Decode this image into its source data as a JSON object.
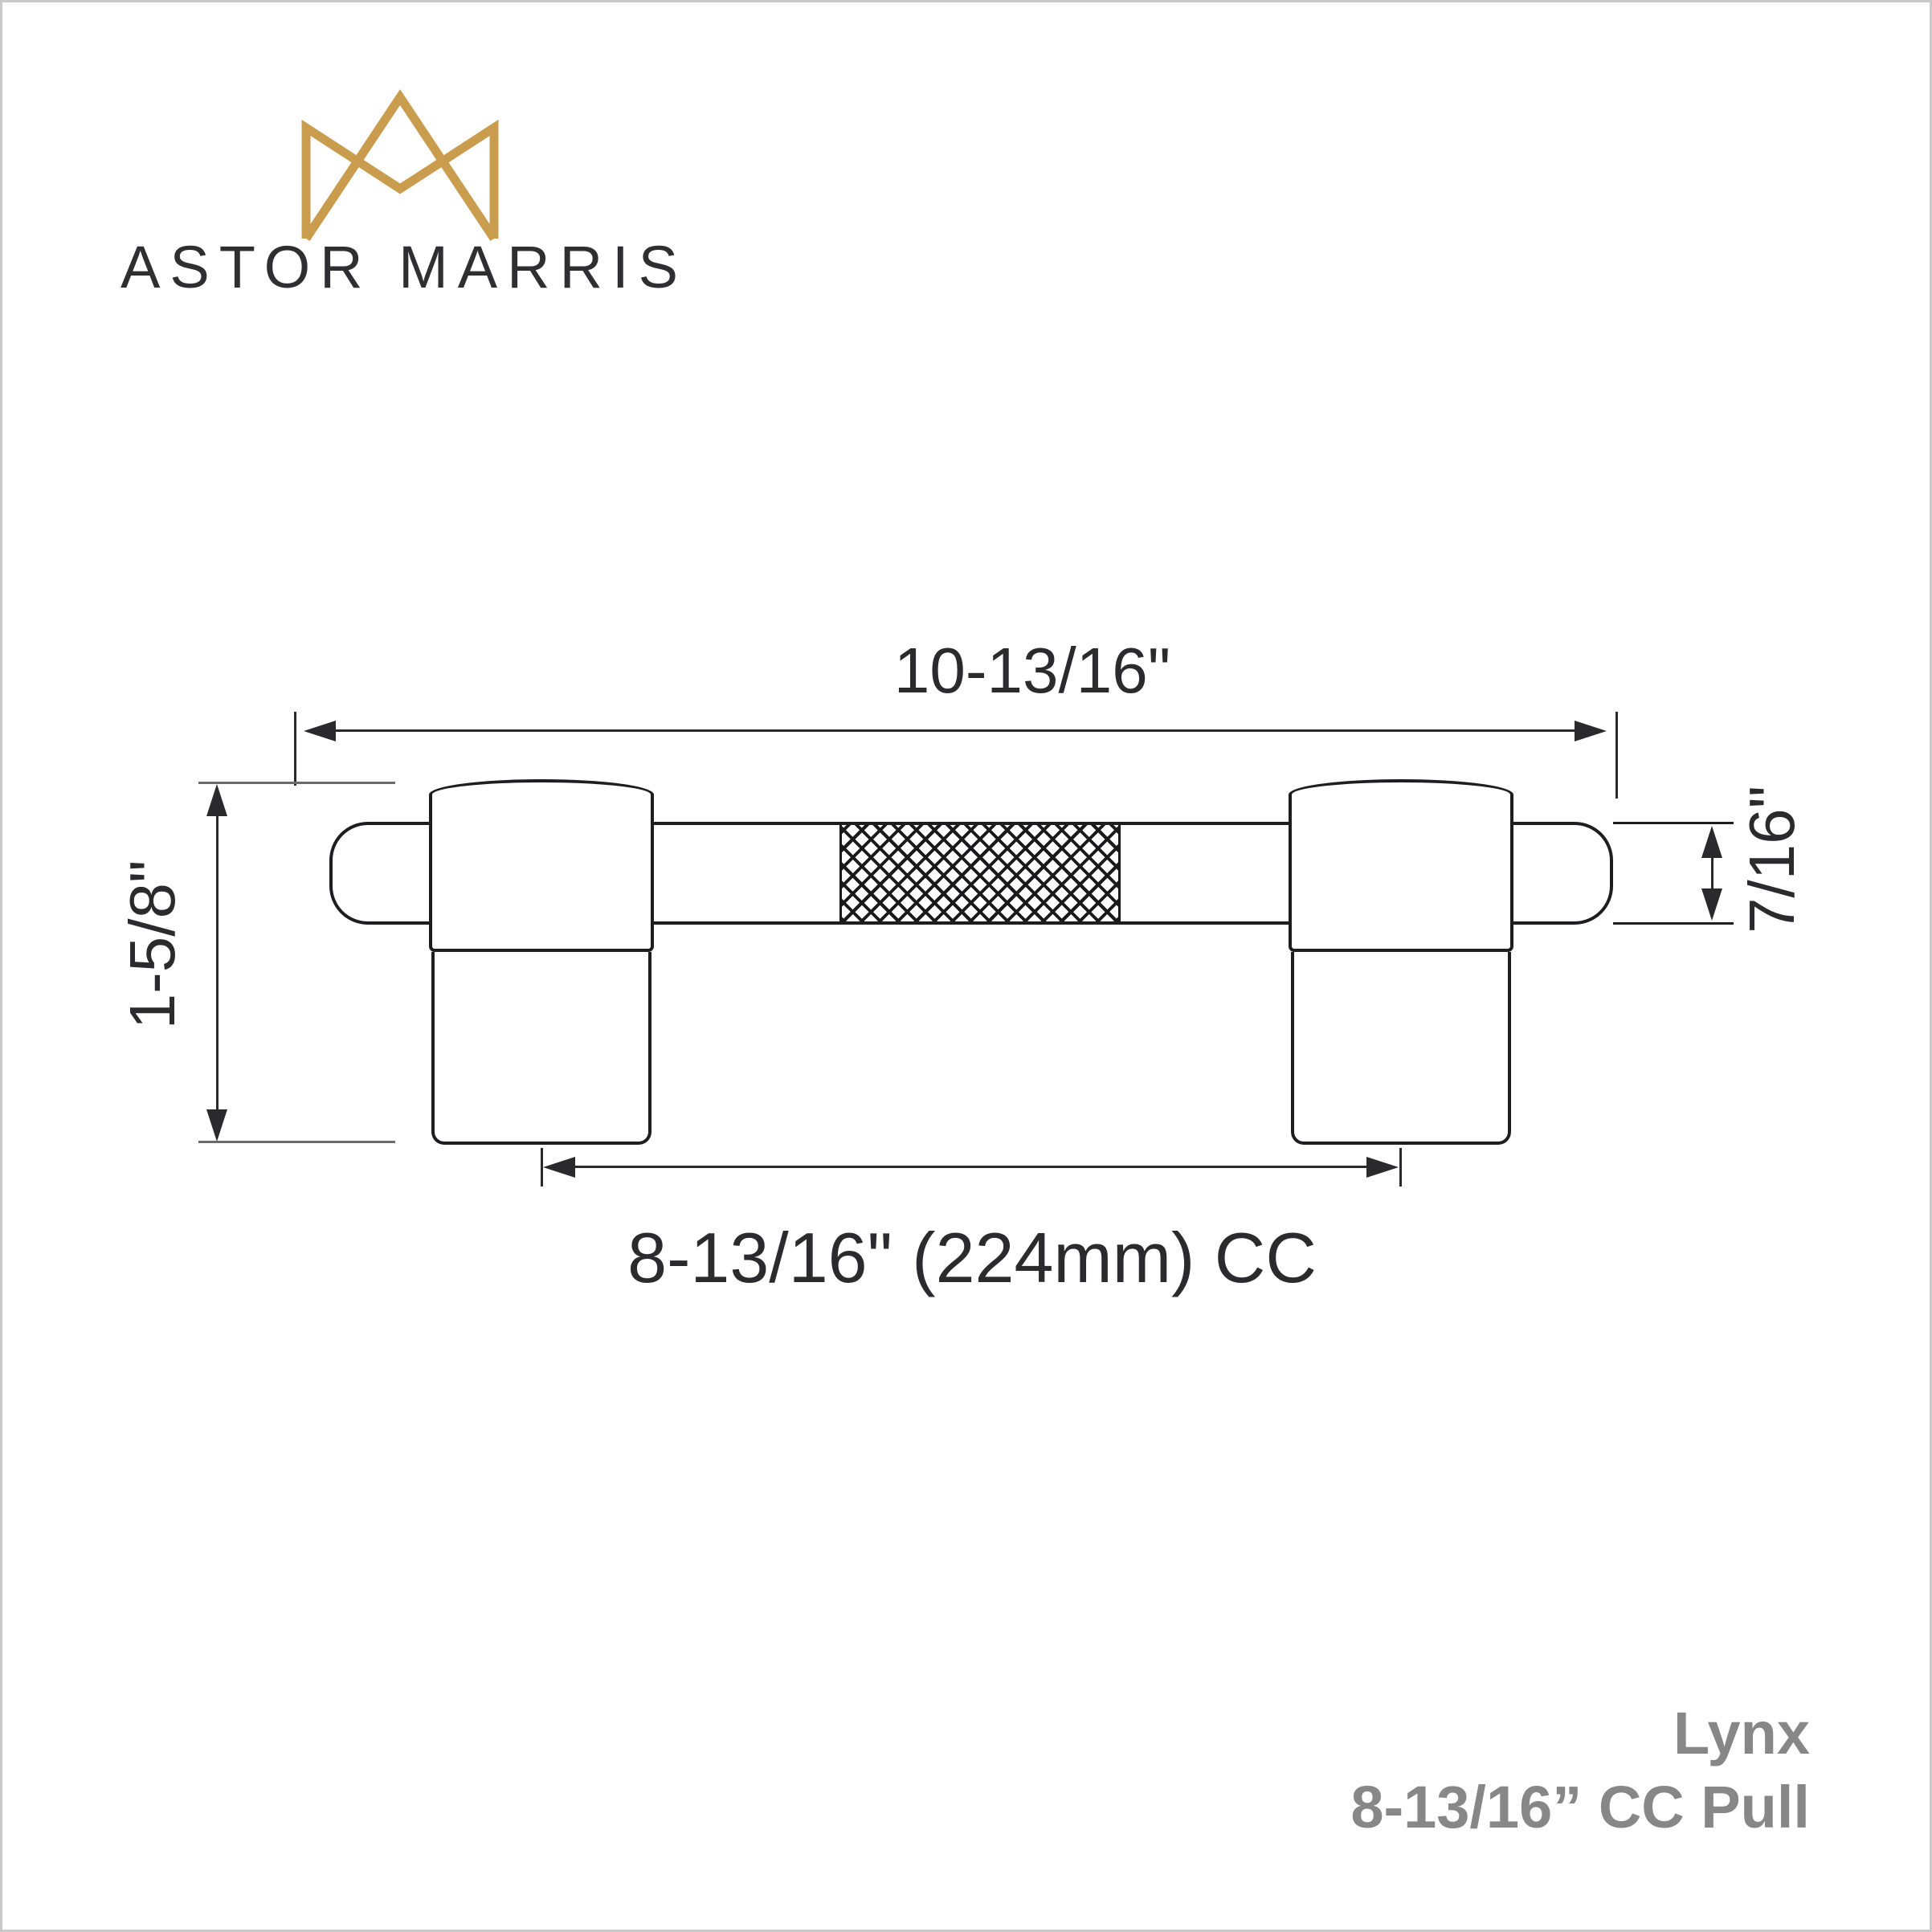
{
  "brand": {
    "name": "ASTOR MARRIS",
    "logo_icon": "crown-monogram-icon",
    "logo_color": "#C99C4E",
    "text_color": "#2F2F31"
  },
  "drawing": {
    "line_color": "#1E1E20",
    "knurl_pattern": "diamond-crosshatch",
    "dimensions": {
      "overall_length": "10-13/16\"",
      "overall_height": "1-5/8\"",
      "bar_diameter": "7/16\"",
      "center_to_center": "8-13/16\" (224mm) CC"
    }
  },
  "footer": {
    "product_name": "Lynx",
    "product_spec": "8-13/16” CC Pull",
    "text_color": "#878787"
  }
}
